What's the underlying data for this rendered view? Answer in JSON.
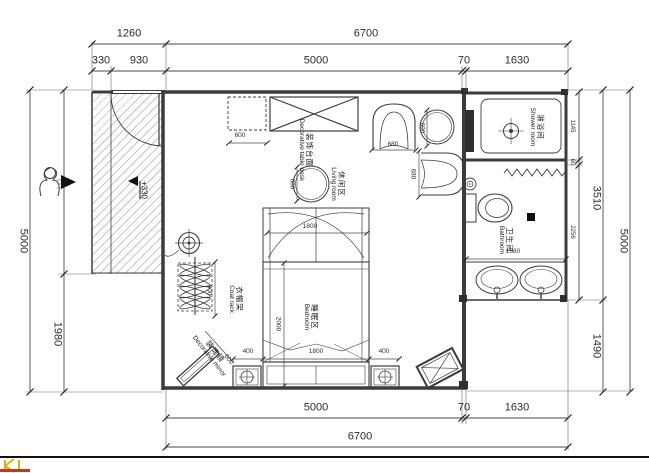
{
  "drawing": {
    "dims_top": {
      "total_left": "1260",
      "total": "6700",
      "seg330": "330",
      "seg930": "930",
      "seg5000": "5000",
      "seg70": "70",
      "seg1630": "1630"
    },
    "dims_bottom": {
      "seg5000": "5000",
      "seg70": "70",
      "seg1630": "1630",
      "total": "6700"
    },
    "dims_left": {
      "total": "5000",
      "seg1980": "1980"
    },
    "dims_right": {
      "seg1145": "1145",
      "seg60": "60",
      "seg2256": "2256",
      "seg3510": "3510",
      "seg1490": "1490",
      "total": "5000"
    },
    "dims_inner": {
      "cabinet_600": "600",
      "table_600": "600",
      "side_table_600": "600",
      "chair_680_w": "680",
      "chair_680_h": "680",
      "canopy_1800": "1800",
      "bed_2000": "2000",
      "bed_400_left": "400",
      "bed_1800": "1800",
      "bed_400_right": "400",
      "coat_900": "900",
      "mirror_600": "600",
      "bath_1580": "1580"
    },
    "level_marker": "+330",
    "rooms": {
      "shower": {
        "cn": "淋浴间",
        "en": "Shower room"
      },
      "bathroom": {
        "cn": "卫生间",
        "en": "Bathroom"
      },
      "living": {
        "cn": "休闲区",
        "en": "Living room"
      },
      "bedroom": {
        "cn": "睡眠区",
        "en": "Bedroom"
      }
    },
    "furniture": {
      "coat_rack": {
        "cn": "衣帽架",
        "en": "Coat rack"
      },
      "mirror": {
        "cn": "装饰镜",
        "en": "Decorative mirror"
      },
      "table": {
        "cn": "装饰台面",
        "en": "Decorative table desk"
      }
    },
    "colors": {
      "line": "#3c3c3c",
      "accent_yellow": "#dab013",
      "accent_red": "#c03a22"
    }
  }
}
